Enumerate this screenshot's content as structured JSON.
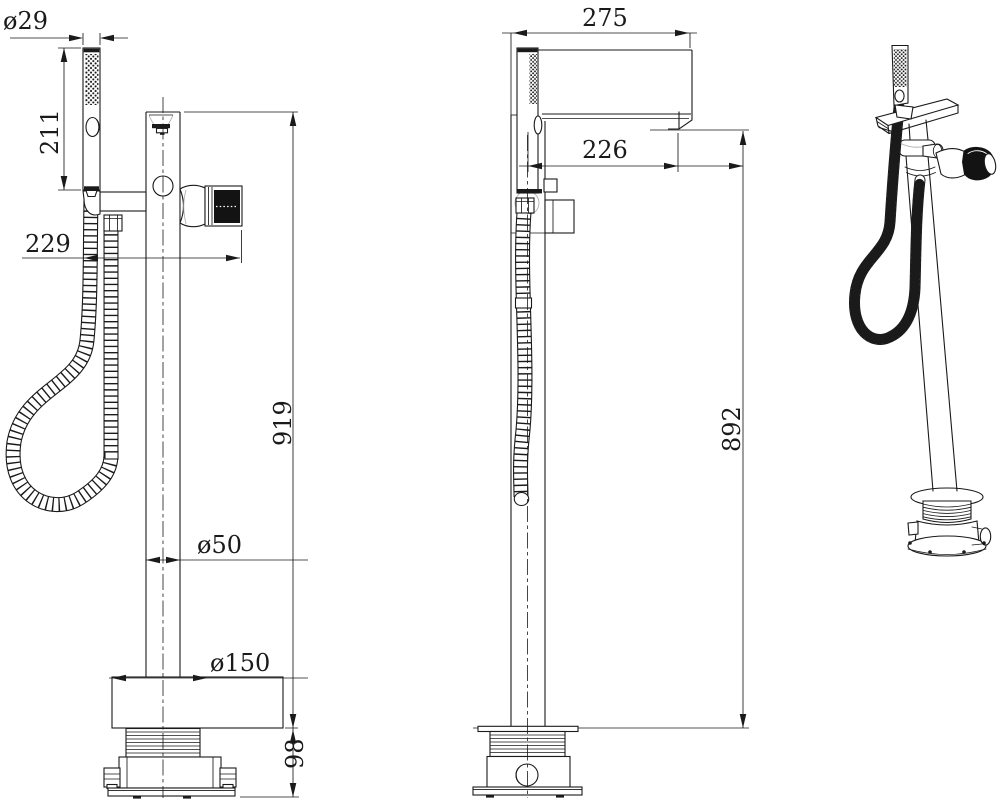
{
  "drawing_type": "technical dimensional drawing - freestanding tub faucet with handshower",
  "dimensions": {
    "front_view": {
      "handshower_diameter": "ø29",
      "handshower_length": "211",
      "hose_offset": "229",
      "overall_height": "919",
      "column_diameter": "ø50",
      "base_cover_diameter": "ø150",
      "underfloor_depth": "98"
    },
    "side_view": {
      "spout_overall": "275",
      "spout_reach": "226",
      "spout_height": "892"
    }
  },
  "colors": {
    "background": "#ffffff",
    "line": "#1a1a1a",
    "knob": "#131313"
  }
}
